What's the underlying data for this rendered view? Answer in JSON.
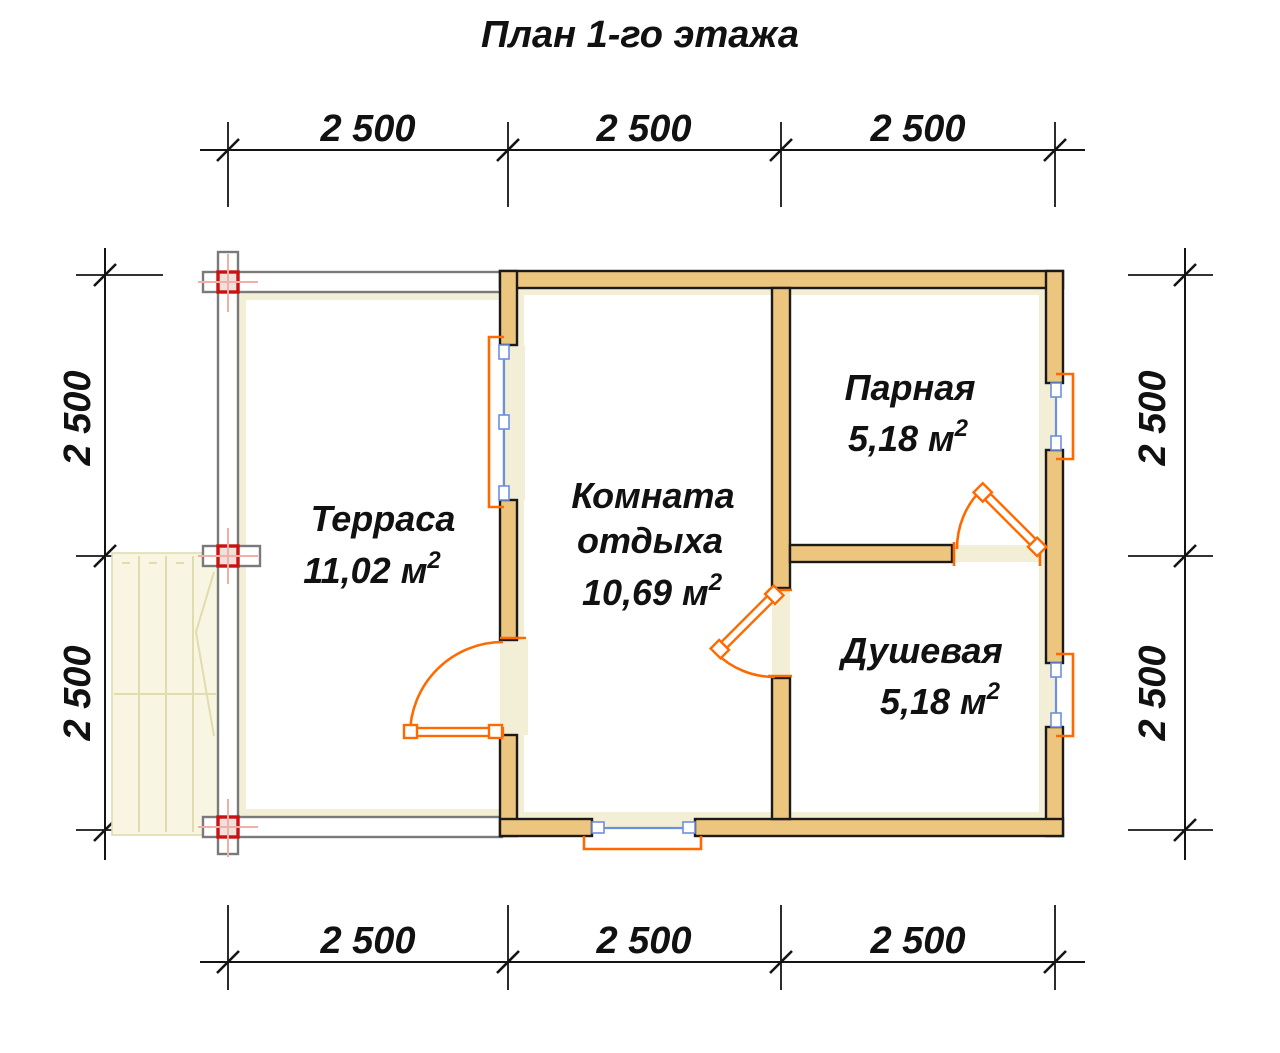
{
  "title": "План 1-го этажа",
  "dimensions": {
    "top": [
      "2 500",
      "2 500",
      "2 500"
    ],
    "bottom": [
      "2 500",
      "2 500",
      "2 500"
    ],
    "left": [
      "2 500",
      "2 500"
    ],
    "right": [
      "2 500",
      "2 500"
    ]
  },
  "rooms": [
    {
      "name": "Терраса",
      "area": "11,02 м",
      "area_sup": "2"
    },
    {
      "name_line1": "Комната",
      "name_line2": "отдыха",
      "area": "10,69 м",
      "area_sup": "2"
    },
    {
      "name": "Парная",
      "area": "5,18 м",
      "area_sup": "2"
    },
    {
      "name": "Душевая",
      "area": "5,18 м",
      "area_sup": "2"
    }
  ],
  "colors": {
    "wall_fill": "#ECC57F",
    "wall_outline": "#1a1a1a",
    "lining_fill": "#F2EFD6",
    "beam_outline": "#7a7a7a",
    "post_marker": "#CC1111",
    "post_crosshair": "#F2AFA8",
    "stairs_fill": "#F8F6E2",
    "stairs_line": "#E0DCAE",
    "door_window": "#FF6A00",
    "window_glass": "#6E8FE0",
    "dim_color": "#141414"
  }
}
